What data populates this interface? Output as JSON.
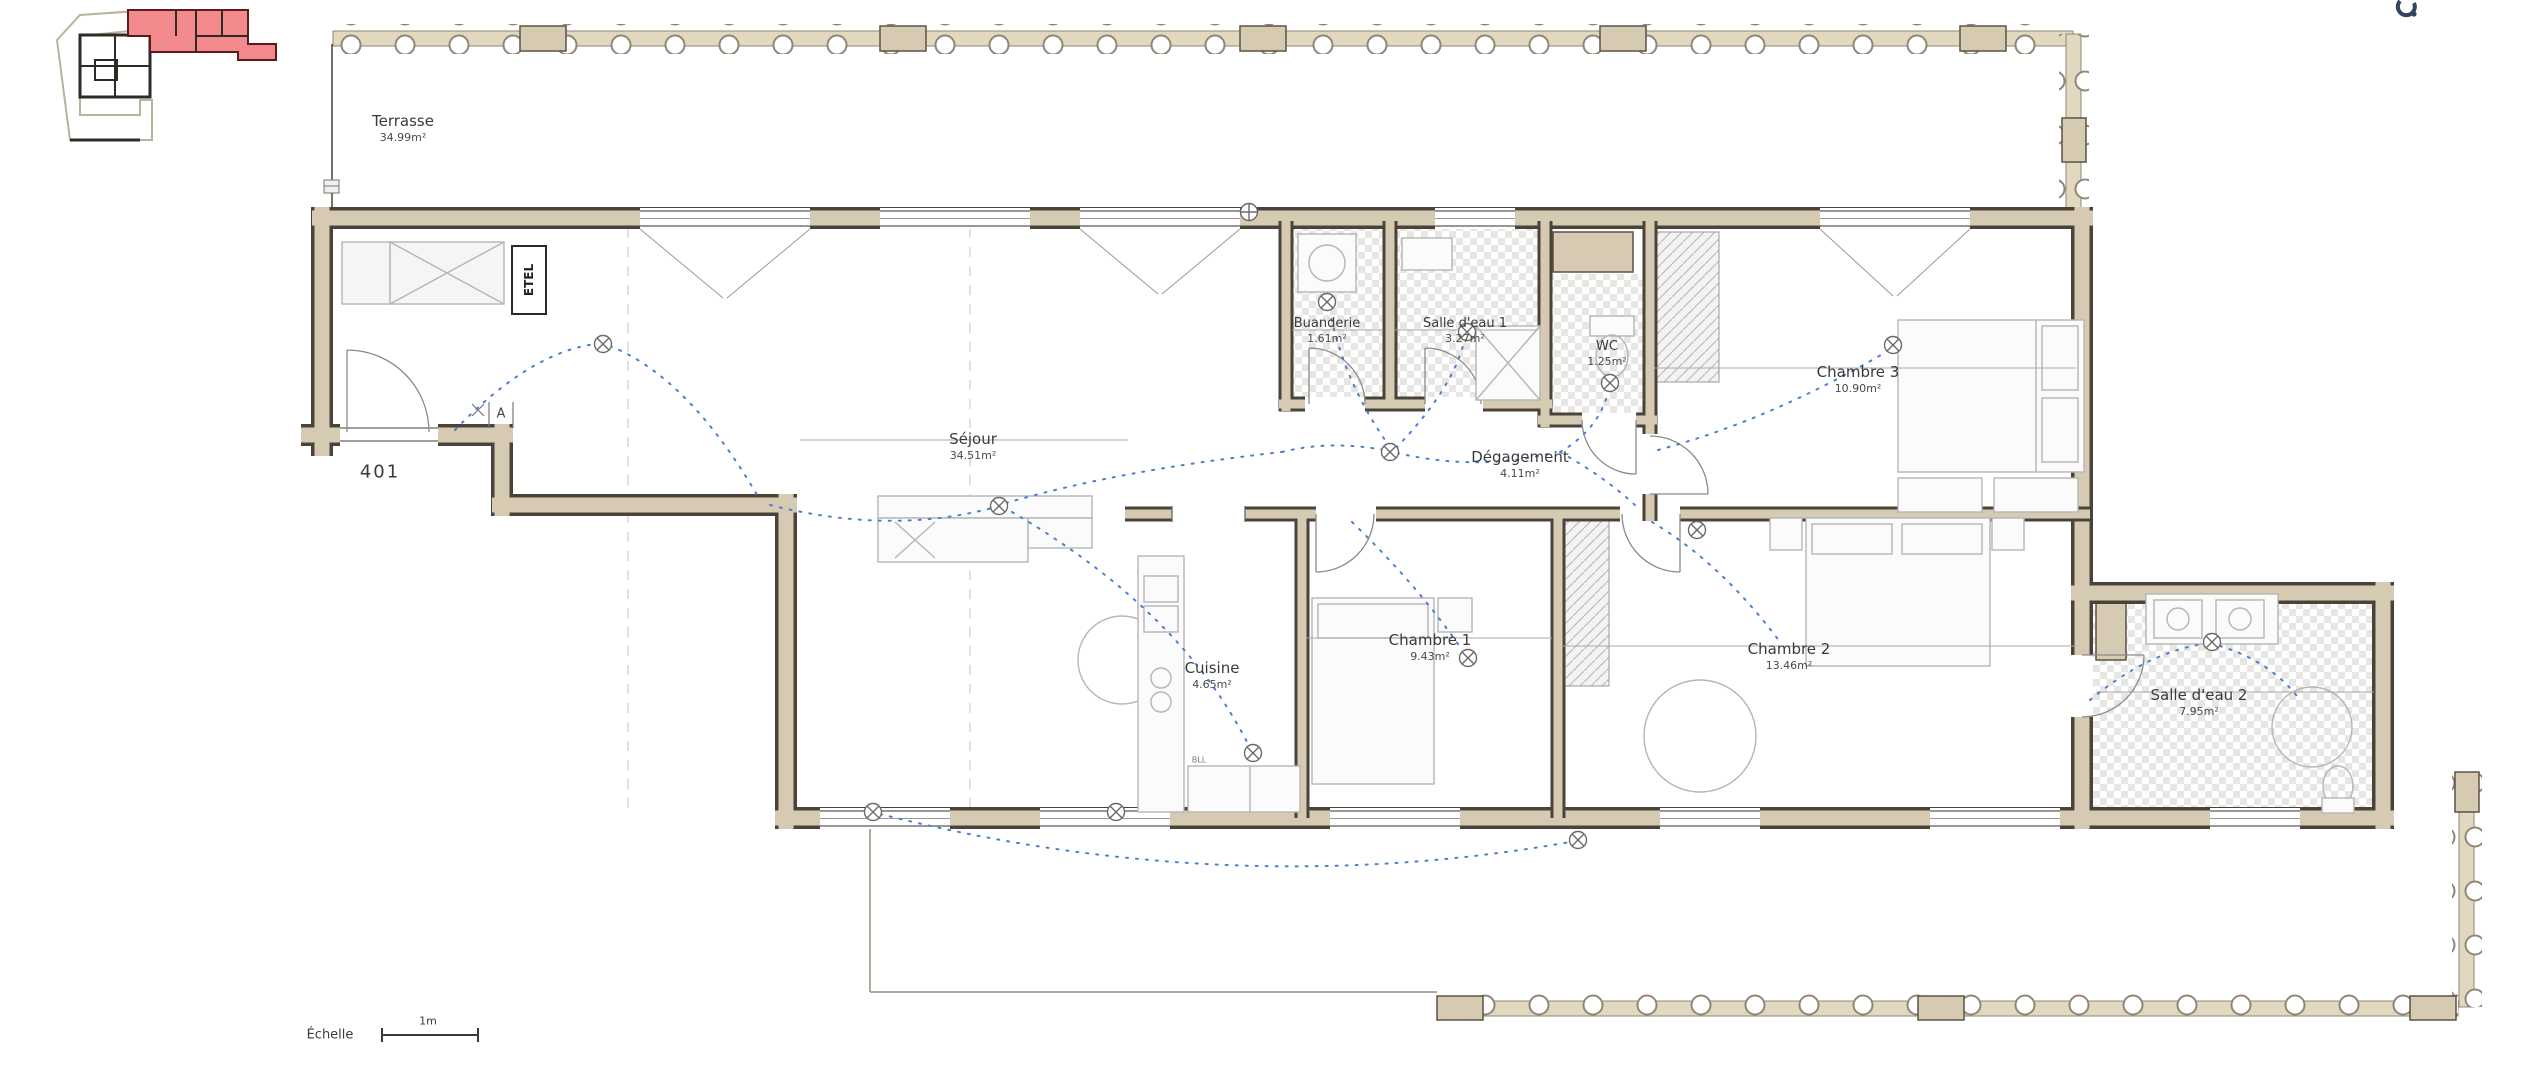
{
  "plan": {
    "unit_number": "401",
    "marker_a": "A",
    "closet_label": "ETEL",
    "kitchen_label": "BLL",
    "scale": {
      "label": "Échelle",
      "length": "1m"
    },
    "rooms": {
      "terrasse": {
        "name": "Terrasse",
        "area": "34.99m²"
      },
      "sejour": {
        "name": "Séjour",
        "area": "34.51m²"
      },
      "buanderie": {
        "name": "Buanderie",
        "area": "1.61m²"
      },
      "salle_eau_1": {
        "name": "Salle d'eau 1",
        "area": "3.27m²"
      },
      "wc": {
        "name": "WC",
        "area": "1.25m²"
      },
      "chambre_3": {
        "name": "Chambre 3",
        "area": "10.90m²"
      },
      "degagement": {
        "name": "Dégagement",
        "area": "4.11m²"
      },
      "cuisine": {
        "name": "Cuisine",
        "area": "4.65m²"
      },
      "chambre_1": {
        "name": "Chambre 1",
        "area": "9.43m²"
      },
      "chambre_2": {
        "name": "Chambre 2",
        "area": "13.46m²"
      },
      "salle_eau_2": {
        "name": "Salle d'eau 2",
        "area": "7.95m²"
      }
    },
    "colors": {
      "wall_fill": "#d6cbb2",
      "wall_edge": "#4a433a",
      "highlight_unit": "#f2898d",
      "wiring_blue": "#4a7fd0",
      "furniture_grey": "#b5b5b5",
      "text": "#3a3a3a"
    }
  }
}
